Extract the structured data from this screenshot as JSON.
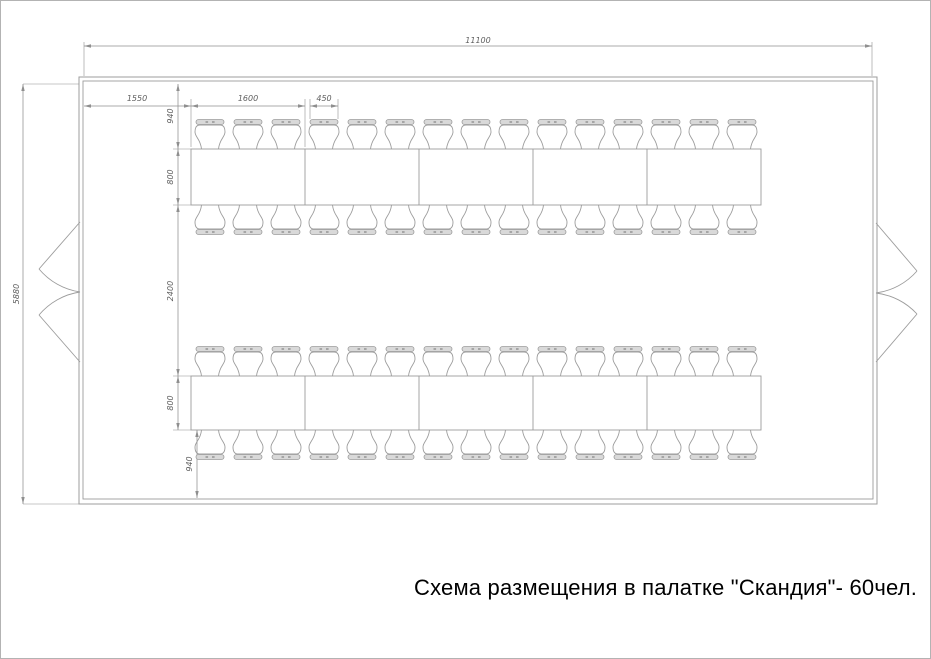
{
  "caption": {
    "text": "Схема размещения в палатке \"Скандия\"- 60чел."
  },
  "dimensions_mm": {
    "tent_width": "11100",
    "tent_depth": "5880",
    "wall_to_first_table": "1550",
    "table_section_length": "1600",
    "chair_width": "450",
    "chair_zone_depth_top": "940",
    "table_depth_top": "800",
    "aisle_between_tables": "2400",
    "table_depth_bottom": "800",
    "chair_zone_depth_bottom": "940"
  },
  "layout_info": {
    "table_rows": 2,
    "sections_per_table_row": 5,
    "chairs_per_long_side": 15,
    "total_seats": 60,
    "entrances": 2
  },
  "colors": {
    "line": "#9c9c9c",
    "dimension_line": "#8f8f8f",
    "dimension_text": "#5f5f5f",
    "seat_back_fill": "#d9d9d9",
    "seat_back_dot": "#9a9a9a",
    "caption_text": "#000000",
    "background": "#ffffff",
    "page_border": "#b3b3b3"
  }
}
